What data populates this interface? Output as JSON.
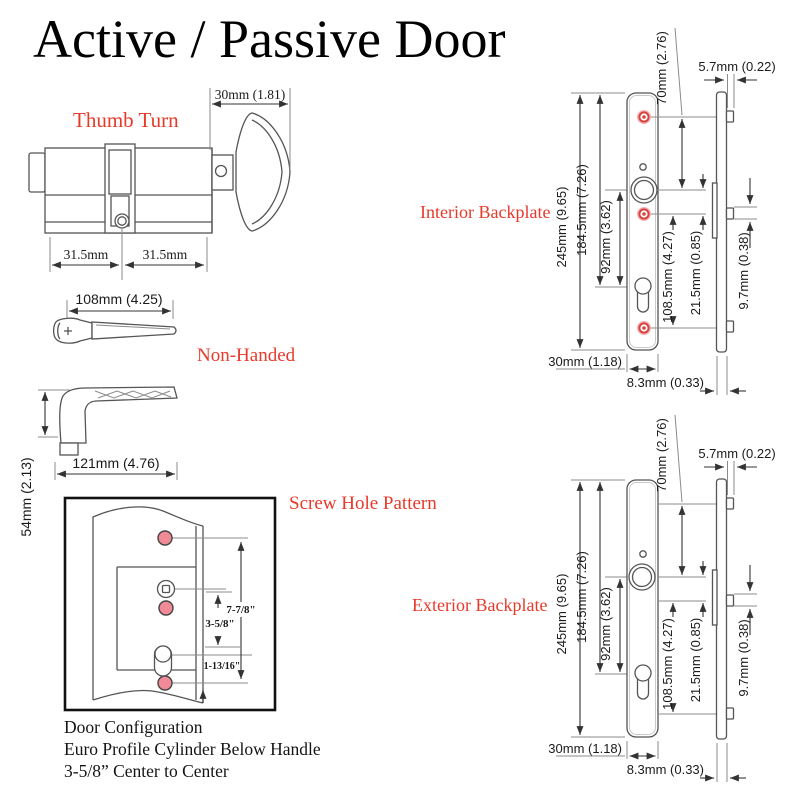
{
  "title": "Active / Passive Door",
  "colors": {
    "accent_red": "#e8392a",
    "screw_pink": "#f08a97",
    "line": "#555555"
  },
  "cylinder": {
    "label": "Thumb Turn",
    "knob_depth": "30mm (1.81)",
    "left_half": "31.5mm",
    "right_half": "31.5mm"
  },
  "handle_top": {
    "label": "Non-Handed",
    "length": "108mm (4.25)"
  },
  "handle_side": {
    "length": "121mm (4.76)",
    "height": "54mm (2.13)"
  },
  "screw_pattern": {
    "label": "Screw Hole Pattern",
    "total_span": "7-7/8\"",
    "center_span": "3-5/8\"",
    "bottom_span": "1-13/16\"",
    "caption_line1": "Door Configuration",
    "caption_line2": "Euro Profile Cylinder Below Handle",
    "caption_line3": "3-5/8” Center to Center"
  },
  "interior": {
    "label": "Interior Backplate",
    "dims": {
      "total_height": "245mm (9.65)",
      "top_to_keyhole": "184.5mm (7.26)",
      "handle_to_keyhole": "92mm (3.62)",
      "screw_spacing": "108.5mm (4.27)",
      "handle_to_screw": "21.5mm (0.85)",
      "handle_to_top_screw": "70mm (2.76)",
      "plate_thickness": "5.7mm (0.22)",
      "screw_projection": "9.7mm (0.38)",
      "plate_width": "30mm (1.18)",
      "edge_offset": "8.3mm (0.33)"
    }
  },
  "exterior": {
    "label": "Exterior Backplate",
    "dims": {
      "total_height": "245mm (9.65)",
      "top_to_keyhole": "184.5mm (7.26)",
      "handle_to_keyhole": "92mm (3.62)",
      "screw_spacing": "108.5mm (4.27)",
      "handle_to_screw": "21.5mm (0.85)",
      "handle_to_top_screw": "70mm (2.76)",
      "plate_thickness": "5.7mm (0.22)",
      "screw_projection": "9.7mm (0.38)",
      "plate_width": "30mm (1.18)",
      "edge_offset": "8.3mm (0.33)"
    }
  }
}
